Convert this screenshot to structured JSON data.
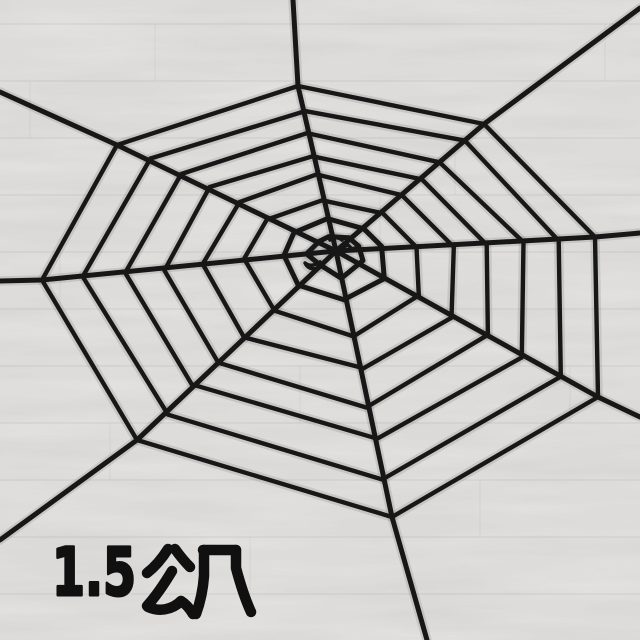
{
  "image": {
    "kind": "product-photo",
    "subject": "black plush spider web Halloween decoration spread on a light grey wood plank floor"
  },
  "label": {
    "text": "1.5公尺",
    "numeric": "1.5",
    "unit": "公尺",
    "color": "#101010"
  },
  "colors": {
    "web": "#171717",
    "floor_base": "#e4e3e1",
    "floor_seam": "#9f9e9c"
  },
  "web": {
    "center": [
      336,
      251
    ],
    "spokes": [
      {
        "name": "top",
        "outer": [
          298,
          86
        ],
        "exit": [
          293,
          0
        ]
      },
      {
        "name": "top-right",
        "outer": [
          484,
          124
        ],
        "exit": [
          640,
          8
        ]
      },
      {
        "name": "right",
        "outer": [
          595,
          237
        ],
        "exit": [
          640,
          233
        ]
      },
      {
        "name": "bottom-right",
        "outer": [
          598,
          397
        ],
        "exit": [
          640,
          417
        ]
      },
      {
        "name": "bottom",
        "outer": [
          392,
          517
        ],
        "exit": [
          427,
          640
        ]
      },
      {
        "name": "bottom-left",
        "outer": [
          137,
          440
        ],
        "exit": [
          0,
          540
        ]
      },
      {
        "name": "left",
        "outer": [
          42,
          280
        ],
        "exit": [
          0,
          281
        ]
      },
      {
        "name": "top-left",
        "outer": [
          117,
          145
        ],
        "exit": [
          0,
          92
        ]
      }
    ],
    "ring_fractions": [
      1,
      0.855,
      0.715,
      0.58,
      0.45,
      0.315,
      0.185,
      0.09
    ],
    "spoke_width": 5,
    "ring_width": 4.4
  },
  "floor": {
    "plank_height": 57,
    "seam_offset": 24,
    "vertical_joints": [
      [
        155,
        0
      ],
      [
        455,
        2
      ],
      [
        60,
        4
      ],
      [
        520,
        5
      ],
      [
        300,
        6
      ],
      [
        605,
        0
      ],
      [
        110,
        7
      ],
      [
        480,
        8
      ],
      [
        250,
        9
      ],
      [
        570,
        6
      ],
      [
        30,
        1
      ],
      [
        380,
        3
      ]
    ]
  }
}
